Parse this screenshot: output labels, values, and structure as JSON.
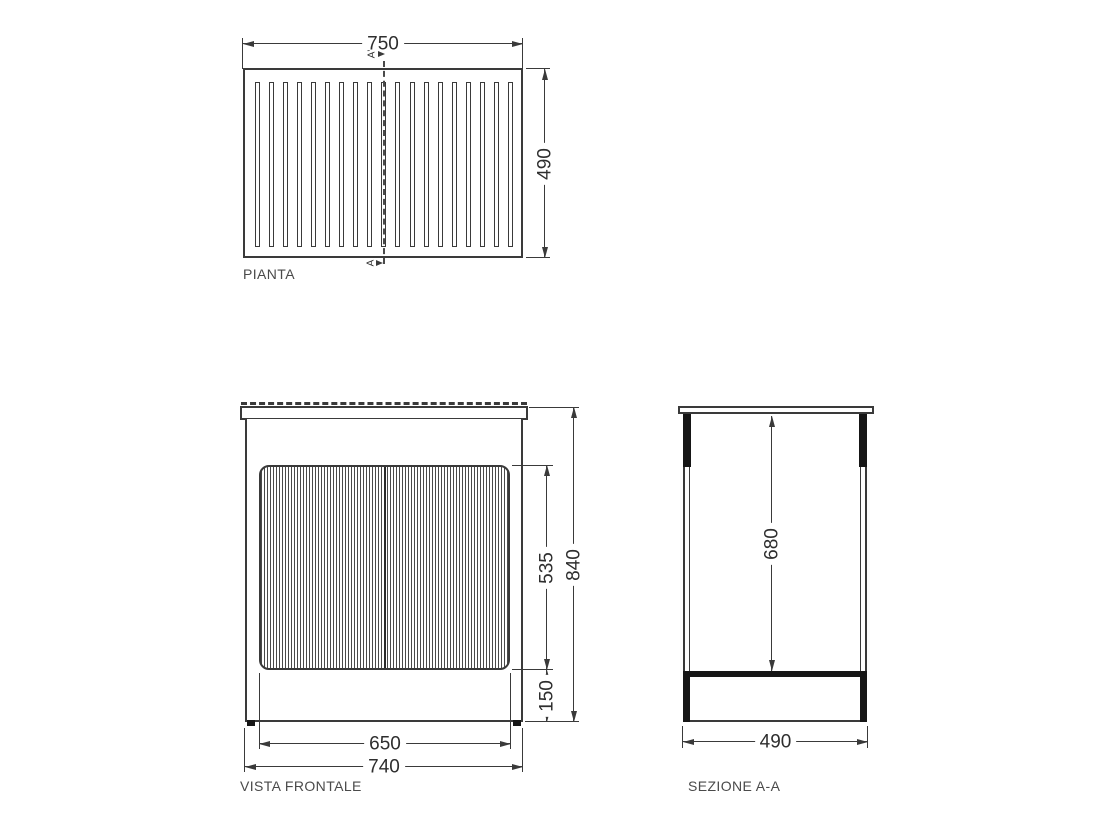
{
  "page": {
    "background": "#ffffff",
    "line_color": "#3a3a3a",
    "heavy_fill_color": "#161616"
  },
  "views": {
    "pianta": {
      "label": "PIANTA",
      "slat_count": 19,
      "width_dim": "750",
      "depth_dim": "490",
      "section_marker_top": "A'",
      "section_marker_bottom": "A"
    },
    "vista_frontale": {
      "label": "VISTA FRONTALE",
      "door_panel_height_dim": "535",
      "overall_height_dim": "840",
      "plinth_height_dim": "150",
      "door_panel_width_dim": "650",
      "cabinet_width_dim": "740"
    },
    "sezione": {
      "label": "SEZIONE A-A",
      "interior_height_dim": "680",
      "depth_dim": "490"
    }
  }
}
